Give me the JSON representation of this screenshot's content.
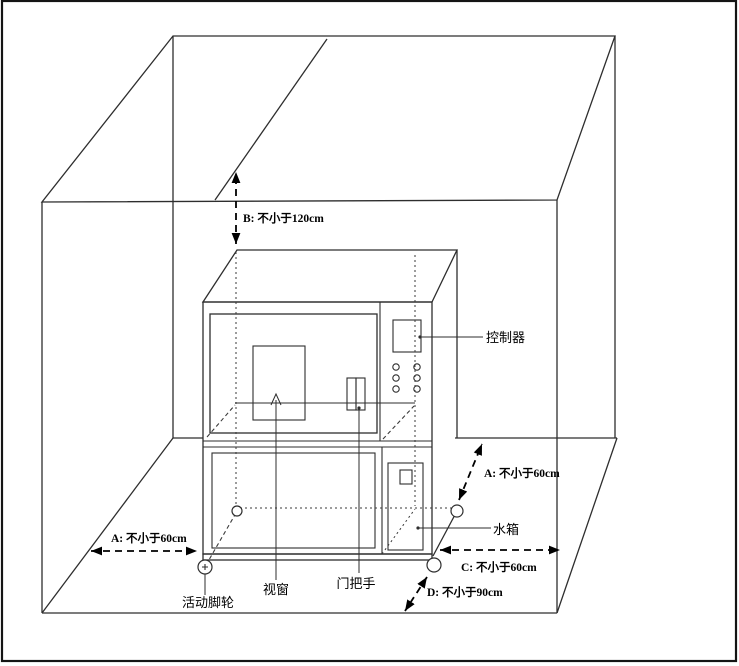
{
  "dims": {
    "b": "B: 不小于120cm",
    "a_left": "A: 不小于60cm",
    "a_right": "A: 不小于60cm",
    "c": "C: 不小于60cm",
    "d": "D: 不小于90cm"
  },
  "parts": {
    "controller": "控制器",
    "water_tank": "水箱",
    "viewing_window": "视窗",
    "door_handle": "门把手",
    "caster": "活动脚轮"
  },
  "colors": {
    "line": "#2e2e2e",
    "text": "#000000",
    "background": "#ffffff",
    "border": "#141414"
  }
}
